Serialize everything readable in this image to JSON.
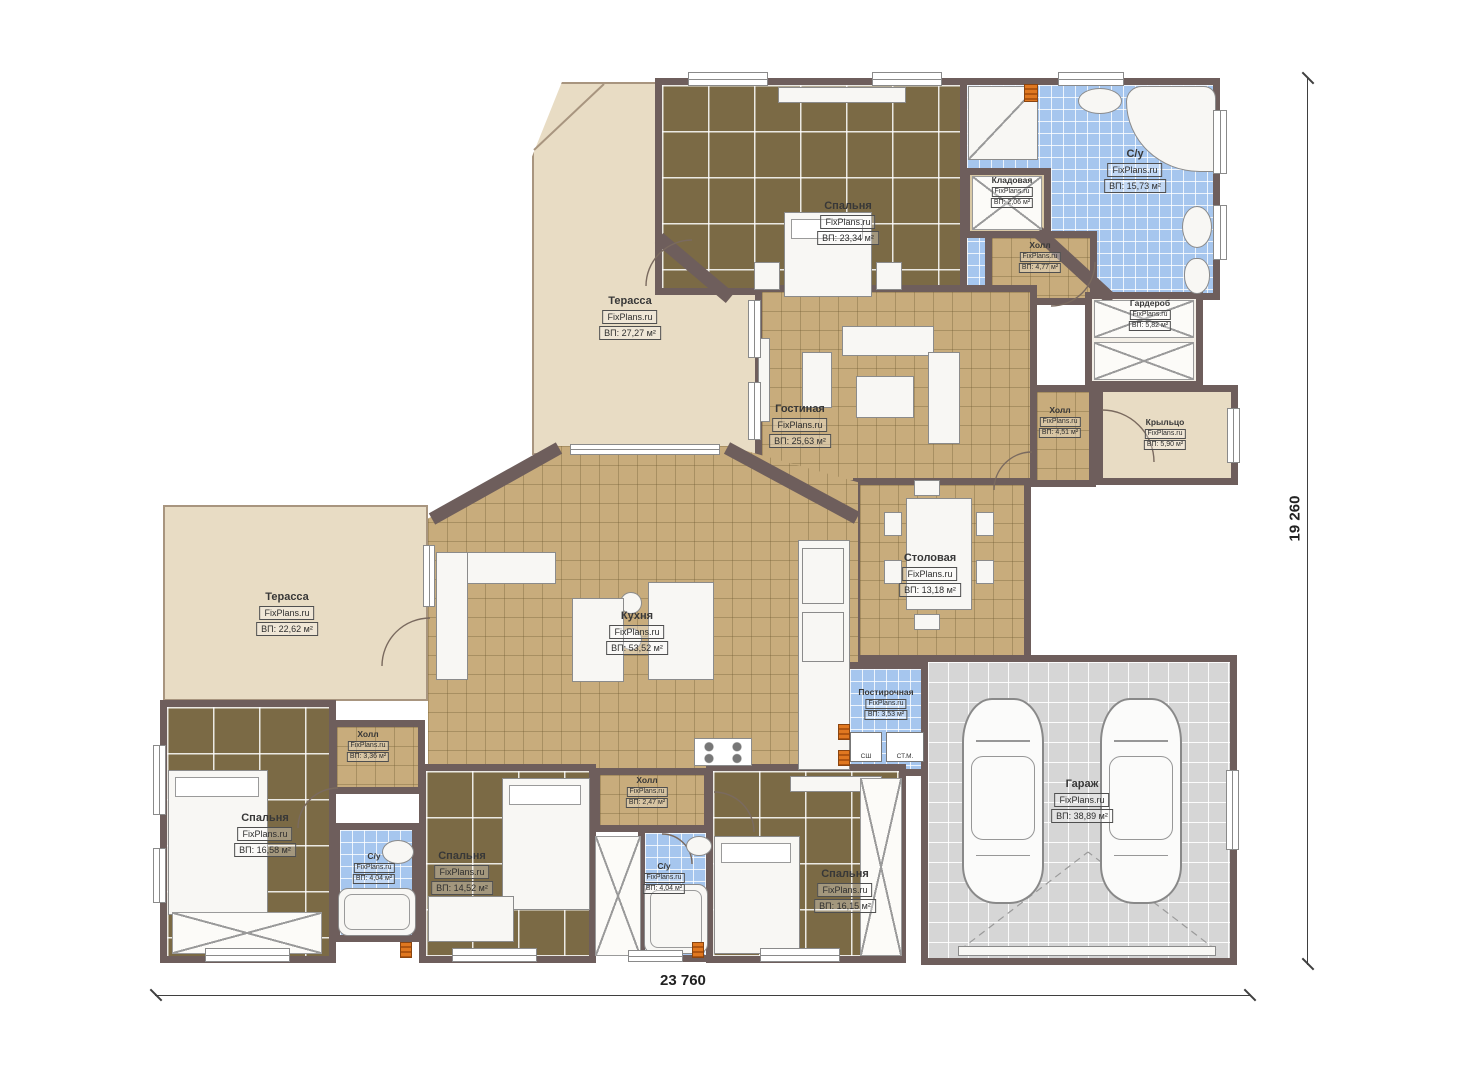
{
  "plan": {
    "source_brand": "FixPlans.ru",
    "type": "floor-plan",
    "language": "ru"
  },
  "dims": {
    "width_label": "23 760",
    "height_label": "19 260"
  },
  "rooms": [
    {
      "name": "Терасса",
      "brand": "FixPlans.ru",
      "area": "ВП: 27,27 м²"
    },
    {
      "name": "Спальня",
      "brand": "FixPlans.ru",
      "area": "ВП: 23,34 м²"
    },
    {
      "name": "С/у",
      "brand": "FixPlans.ru",
      "area": "ВП: 15,73 м²"
    },
    {
      "name": "Кладовая",
      "brand": "FixPlans.ru",
      "area": "ВП: 2,06 м²"
    },
    {
      "name": "Холл",
      "brand": "FixPlans.ru",
      "area": "ВП: 4,77 м²"
    },
    {
      "name": "Гардероб",
      "brand": "FixPlans.ru",
      "area": "ВП: 5,82 м²"
    },
    {
      "name": "Гостиная",
      "brand": "FixPlans.ru",
      "area": "ВП: 25,63 м²"
    },
    {
      "name": "Холл",
      "brand": "FixPlans.ru",
      "area": "ВП: 4,51 м²"
    },
    {
      "name": "Крыльцо",
      "brand": "FixPlans.ru",
      "area": "ВП: 5,90 м²"
    },
    {
      "name": "Столовая",
      "brand": "FixPlans.ru",
      "area": "ВП: 13,18 м²"
    },
    {
      "name": "Кухня",
      "brand": "FixPlans.ru",
      "area": "ВП: 53,52 м²"
    },
    {
      "name": "Терасса",
      "brand": "FixPlans.ru",
      "area": "ВП: 22,62 м²"
    },
    {
      "name": "Постирочная",
      "brand": "FixPlans.ru",
      "area": "ВП: 3,53 м²"
    },
    {
      "name": "Гараж",
      "brand": "FixPlans.ru",
      "area": "ВП: 38,89 м²"
    },
    {
      "name": "Спальня",
      "brand": "FixPlans.ru",
      "area": "ВП: 16,58 м²"
    },
    {
      "name": "Холл",
      "brand": "FixPlans.ru",
      "area": "ВП: 3,36 м²"
    },
    {
      "name": "С/у",
      "brand": "FixPlans.ru",
      "area": "ВП: 4,04 м²"
    },
    {
      "name": "Спальня",
      "brand": "FixPlans.ru",
      "area": "ВП: 14,52 м²"
    },
    {
      "name": "Холл",
      "brand": "FixPlans.ru",
      "area": "ВП: 2,47 м²"
    },
    {
      "name": "С/у",
      "brand": "FixPlans.ru",
      "area": "ВП: 4,04 м²"
    },
    {
      "name": "Спальня",
      "brand": "FixPlans.ru",
      "area": "ВП: 16,15 м²"
    }
  ],
  "appliances": {
    "washer_label": "СШ",
    "dryer_label": "СТ.М."
  },
  "colors": {
    "wall": "#6E5E5C",
    "bedroom_floor": "#7B6A45",
    "living_floor": "#C8AC7C",
    "bath_floor": "#A6C6EE",
    "terrace_floor": "#E8DCC4",
    "garage_floor": "#D6D6D6",
    "accent_orange": "#E07820"
  }
}
